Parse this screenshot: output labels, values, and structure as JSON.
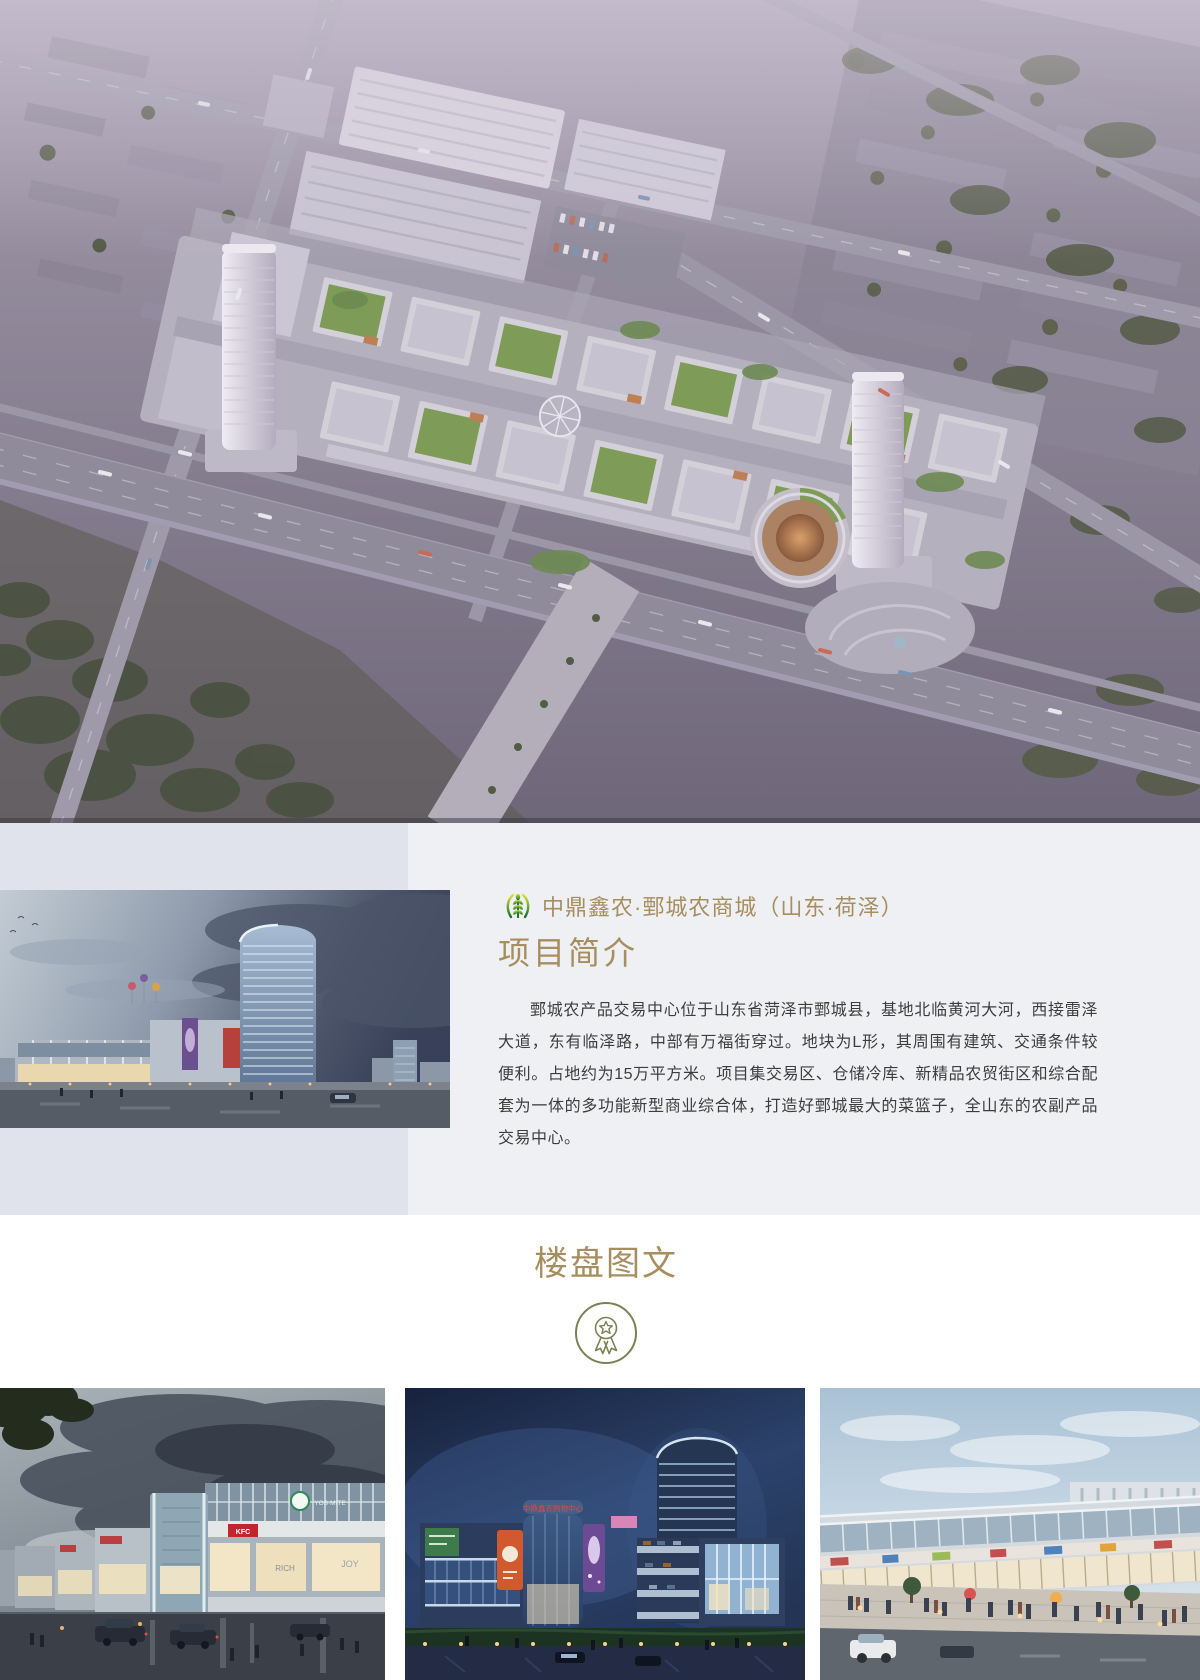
{
  "intro": {
    "brand_title": "中鼎鑫农·鄄城农商城（山东·荷泽）",
    "heading": "项目简介",
    "paragraph": "鄄城农产品交易中心位于山东省菏泽市鄄城县，基地北临黄河大河，西接雷泽大道，东有临泽路，中部有万福街穿过。地块为L形，其周围有建筑、交通条件较便利。占地约为15万平方米。项目集交易区、仓储冷库、新精品农贸街区和综合配套为一体的多功能新型商业综合体，打造好鄄城最大的菜篮子，全山东的农副产品交易中心。",
    "logo_icon": "wheat-sprout-icon",
    "accent_color": "#a68e5f",
    "band_left_color": "#e1e3ec",
    "band_right_color": "#eef0f3",
    "photo_name": "project-dusk-rendering"
  },
  "hero": {
    "name": "aerial-site-rendering"
  },
  "gallery": {
    "heading": "楼盘图文",
    "badge_icon": "medal-award-icon",
    "badge_color": "#7c8055",
    "images": [
      {
        "name": "street-view-dusk-clouds",
        "signs": [
          "YOS·MITE",
          "KFC",
          "RICH",
          "JOY"
        ]
      },
      {
        "name": "mall-night-tower",
        "signs": [
          "中鼎鑫农购物中心"
        ]
      },
      {
        "name": "shopping-street-crowd",
        "signs": []
      }
    ]
  }
}
